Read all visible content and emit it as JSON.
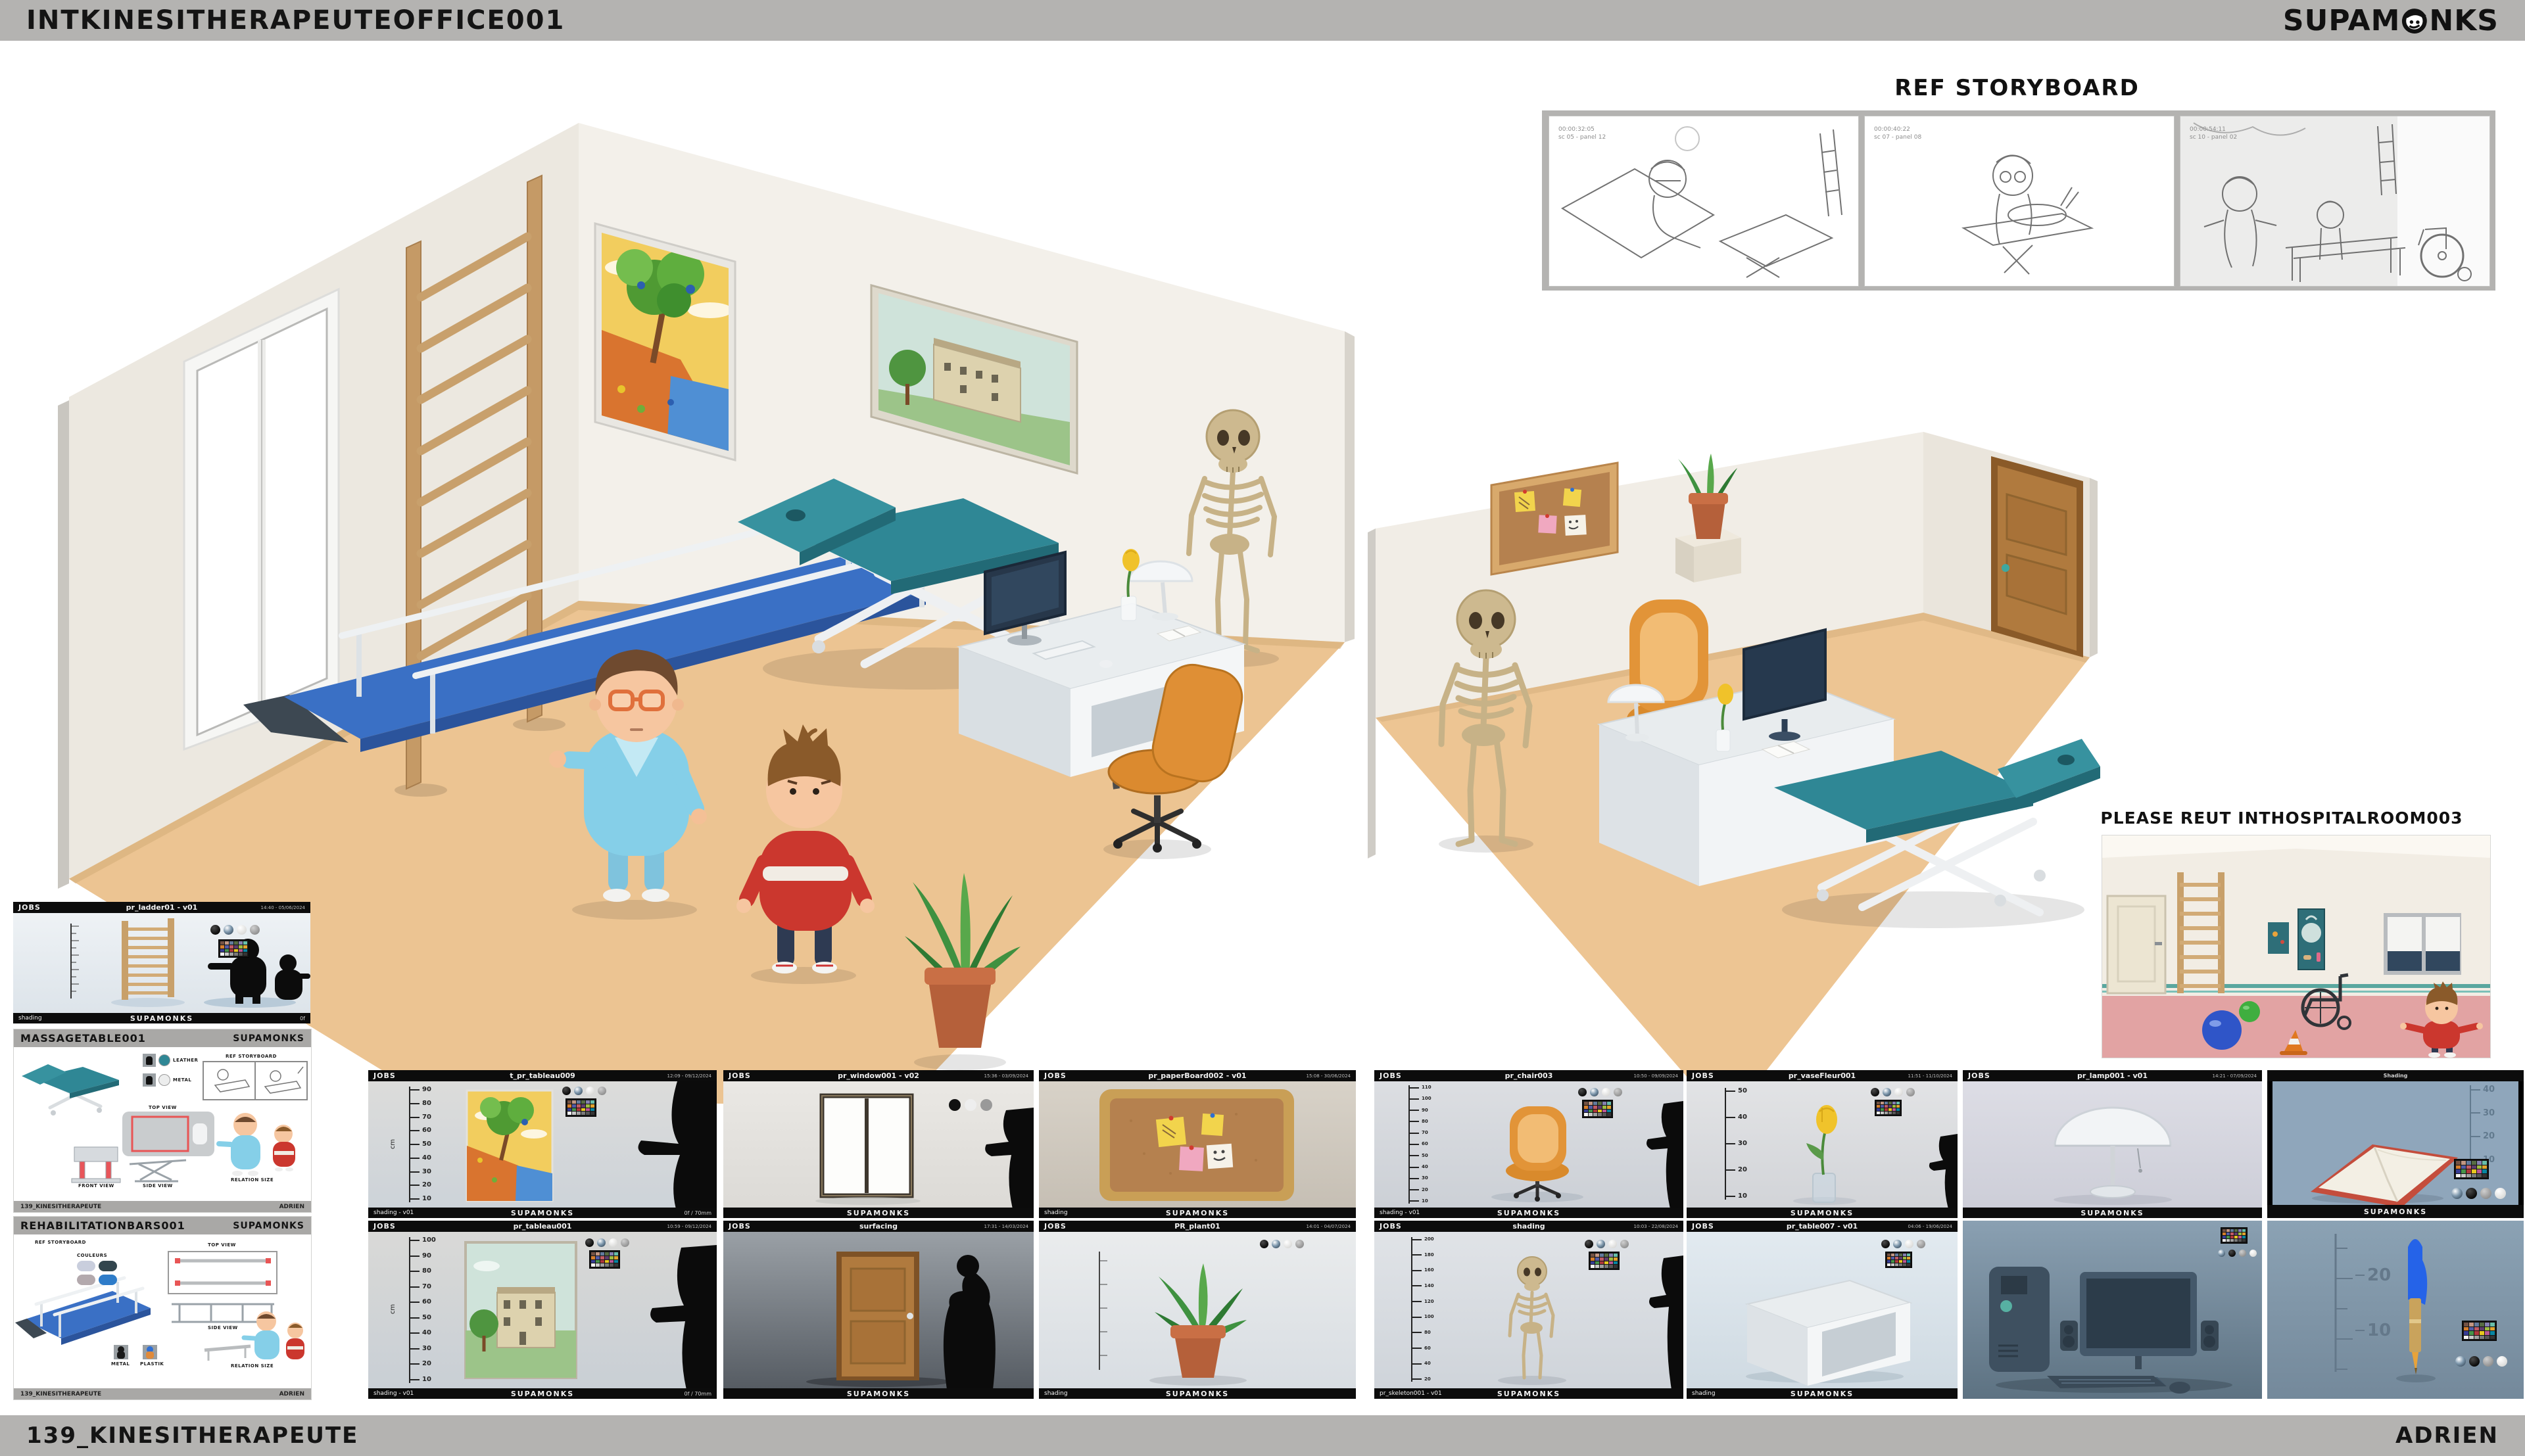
{
  "page": {
    "band_color": "#b4b3b1",
    "canvas_color": "#ffffff"
  },
  "header": {
    "title": "INTKINESITHERAPEUTEOFFICE001",
    "brand_left": "SUPAM",
    "brand_right": "NKS"
  },
  "footer": {
    "project": "139_KINESITHERAPEUTE",
    "author": "ADRIEN"
  },
  "storyboard": {
    "title": "REF STORYBOARD",
    "frames": [
      {
        "timecode": "00:00:32:05",
        "panel": "sc 05 - panel 12"
      },
      {
        "timecode": "00:00:40:22",
        "panel": "sc 07 - panel 08"
      },
      {
        "timecode": "00:00:54:11",
        "panel": "sc 10 - panel 02"
      }
    ]
  },
  "reuse": {
    "title": "PLEASE REUT INTHOSPITALROOM003"
  },
  "labels": {
    "jobs": "JOBS",
    "brand": "SUPAMONKS"
  },
  "ladder_sheet": {
    "title": "pr_ladder01 - v01",
    "meta": "14:40 - 05/06/2024",
    "footer_left": "shading",
    "footer_right": "0f"
  },
  "massage_sheet": {
    "title": "MASSAGETABLE001",
    "leather": "LEATHER",
    "metal": "METAL",
    "top_view": "TOP VIEW",
    "front_view": "FRONT VIEW",
    "side_view": "SIDE VIEW",
    "ref_storyboard": "REF STORYBOARD",
    "relation_size": "RELATION SIZE",
    "footer_left": "139_KINESITHERAPEUTE",
    "footer_right": "ADRIEN"
  },
  "rehab_sheet": {
    "title": "REHABILITATIONBARS001",
    "metal": "METAL",
    "plastik": "PLASTIK",
    "top_view": "TOP VIEW",
    "side_view": "SIDE VIEW",
    "ref_storyboard": "REF STORYBOARD",
    "couleurs": "COULEURS",
    "relation_size": "RELATION SIZE",
    "swatches": [
      "#c9cedd",
      "#33464e",
      "#b3a9ad",
      "#2e7cc9"
    ],
    "footer_left": "139_KINESITHERAPEUTE",
    "footer_right": "ADRIEN"
  },
  "checker_colors": [
    "#735244",
    "#c29682",
    "#627a9d",
    "#576c43",
    "#8580b1",
    "#67bdaa",
    "#d67e2c",
    "#505ba6",
    "#c15a63",
    "#5e3c6c",
    "#9dbc40",
    "#e0a32e",
    "#383d96",
    "#469449",
    "#af363c",
    "#e7c71f",
    "#bb5695",
    "#0885a1",
    "#f3f3f2",
    "#c8c8c8",
    "#a0a0a0",
    "#7a7a7a",
    "#555555",
    "#343434"
  ],
  "thumbs": {
    "r1c1": {
      "title": "t_pr_tableau009",
      "meta": "12:09 - 09/12/2024",
      "ruler_unit": "cm",
      "ruler": [
        90,
        80,
        70,
        60,
        50,
        40,
        30,
        20,
        10
      ],
      "footer_left": "shading - v01",
      "footer_right": "0f / 70mm"
    },
    "r1c2": {
      "title": "pr_window001 - v02",
      "meta": "15:36 - 03/09/2024"
    },
    "r1c3": {
      "title": "pr_paperBoard002 - v01",
      "meta": "15:08 - 30/06/2024",
      "footer_left": "shading"
    },
    "r1c4": {
      "title": "pr_chair003",
      "meta": "10:50 - 09/09/2024",
      "ruler": [
        110,
        100,
        90,
        80,
        70,
        60,
        50,
        40,
        30,
        20,
        10
      ],
      "footer_left": "shading - v01"
    },
    "r1c5": {
      "title": "pr_vaseFleur001",
      "meta": "11:51 - 11/10/2024",
      "ruler": [
        50,
        40,
        30,
        20,
        10
      ]
    },
    "r1c6": {
      "title": "pr_lamp001 - v01",
      "meta": "14:21 - 07/09/2024"
    },
    "r1c7": {
      "title": "Shading",
      "ruler": [
        40,
        30,
        20,
        10
      ]
    },
    "r2c1": {
      "title": "pr_tableau001",
      "meta": "10:59 - 09/12/2024",
      "ruler_unit": "cm",
      "ruler": [
        100,
        90,
        80,
        70,
        60,
        50,
        40,
        30,
        20,
        10
      ],
      "footer_left": "shading - v01",
      "footer_right": "0f / 70mm"
    },
    "r2c2": {
      "title": "surfacing",
      "meta": "17:31 - 14/03/2024"
    },
    "r2c3": {
      "title": "PR_plant01",
      "meta": "14:01 - 04/07/2024",
      "footer_left": "shading"
    },
    "r2c4": {
      "title": "shading",
      "meta": "10:03 - 22/08/2024",
      "ruler": [
        200,
        180,
        160,
        140,
        120,
        100,
        80,
        60,
        40,
        20
      ],
      "footer_left": "pr_skeleton001 - v01"
    },
    "r2c5": {
      "title": "pr_table007 - v01",
      "meta": "04:06 - 19/06/2024",
      "footer_left": "shading"
    },
    "r2c7": {
      "ruler": [
        20,
        10
      ]
    }
  }
}
